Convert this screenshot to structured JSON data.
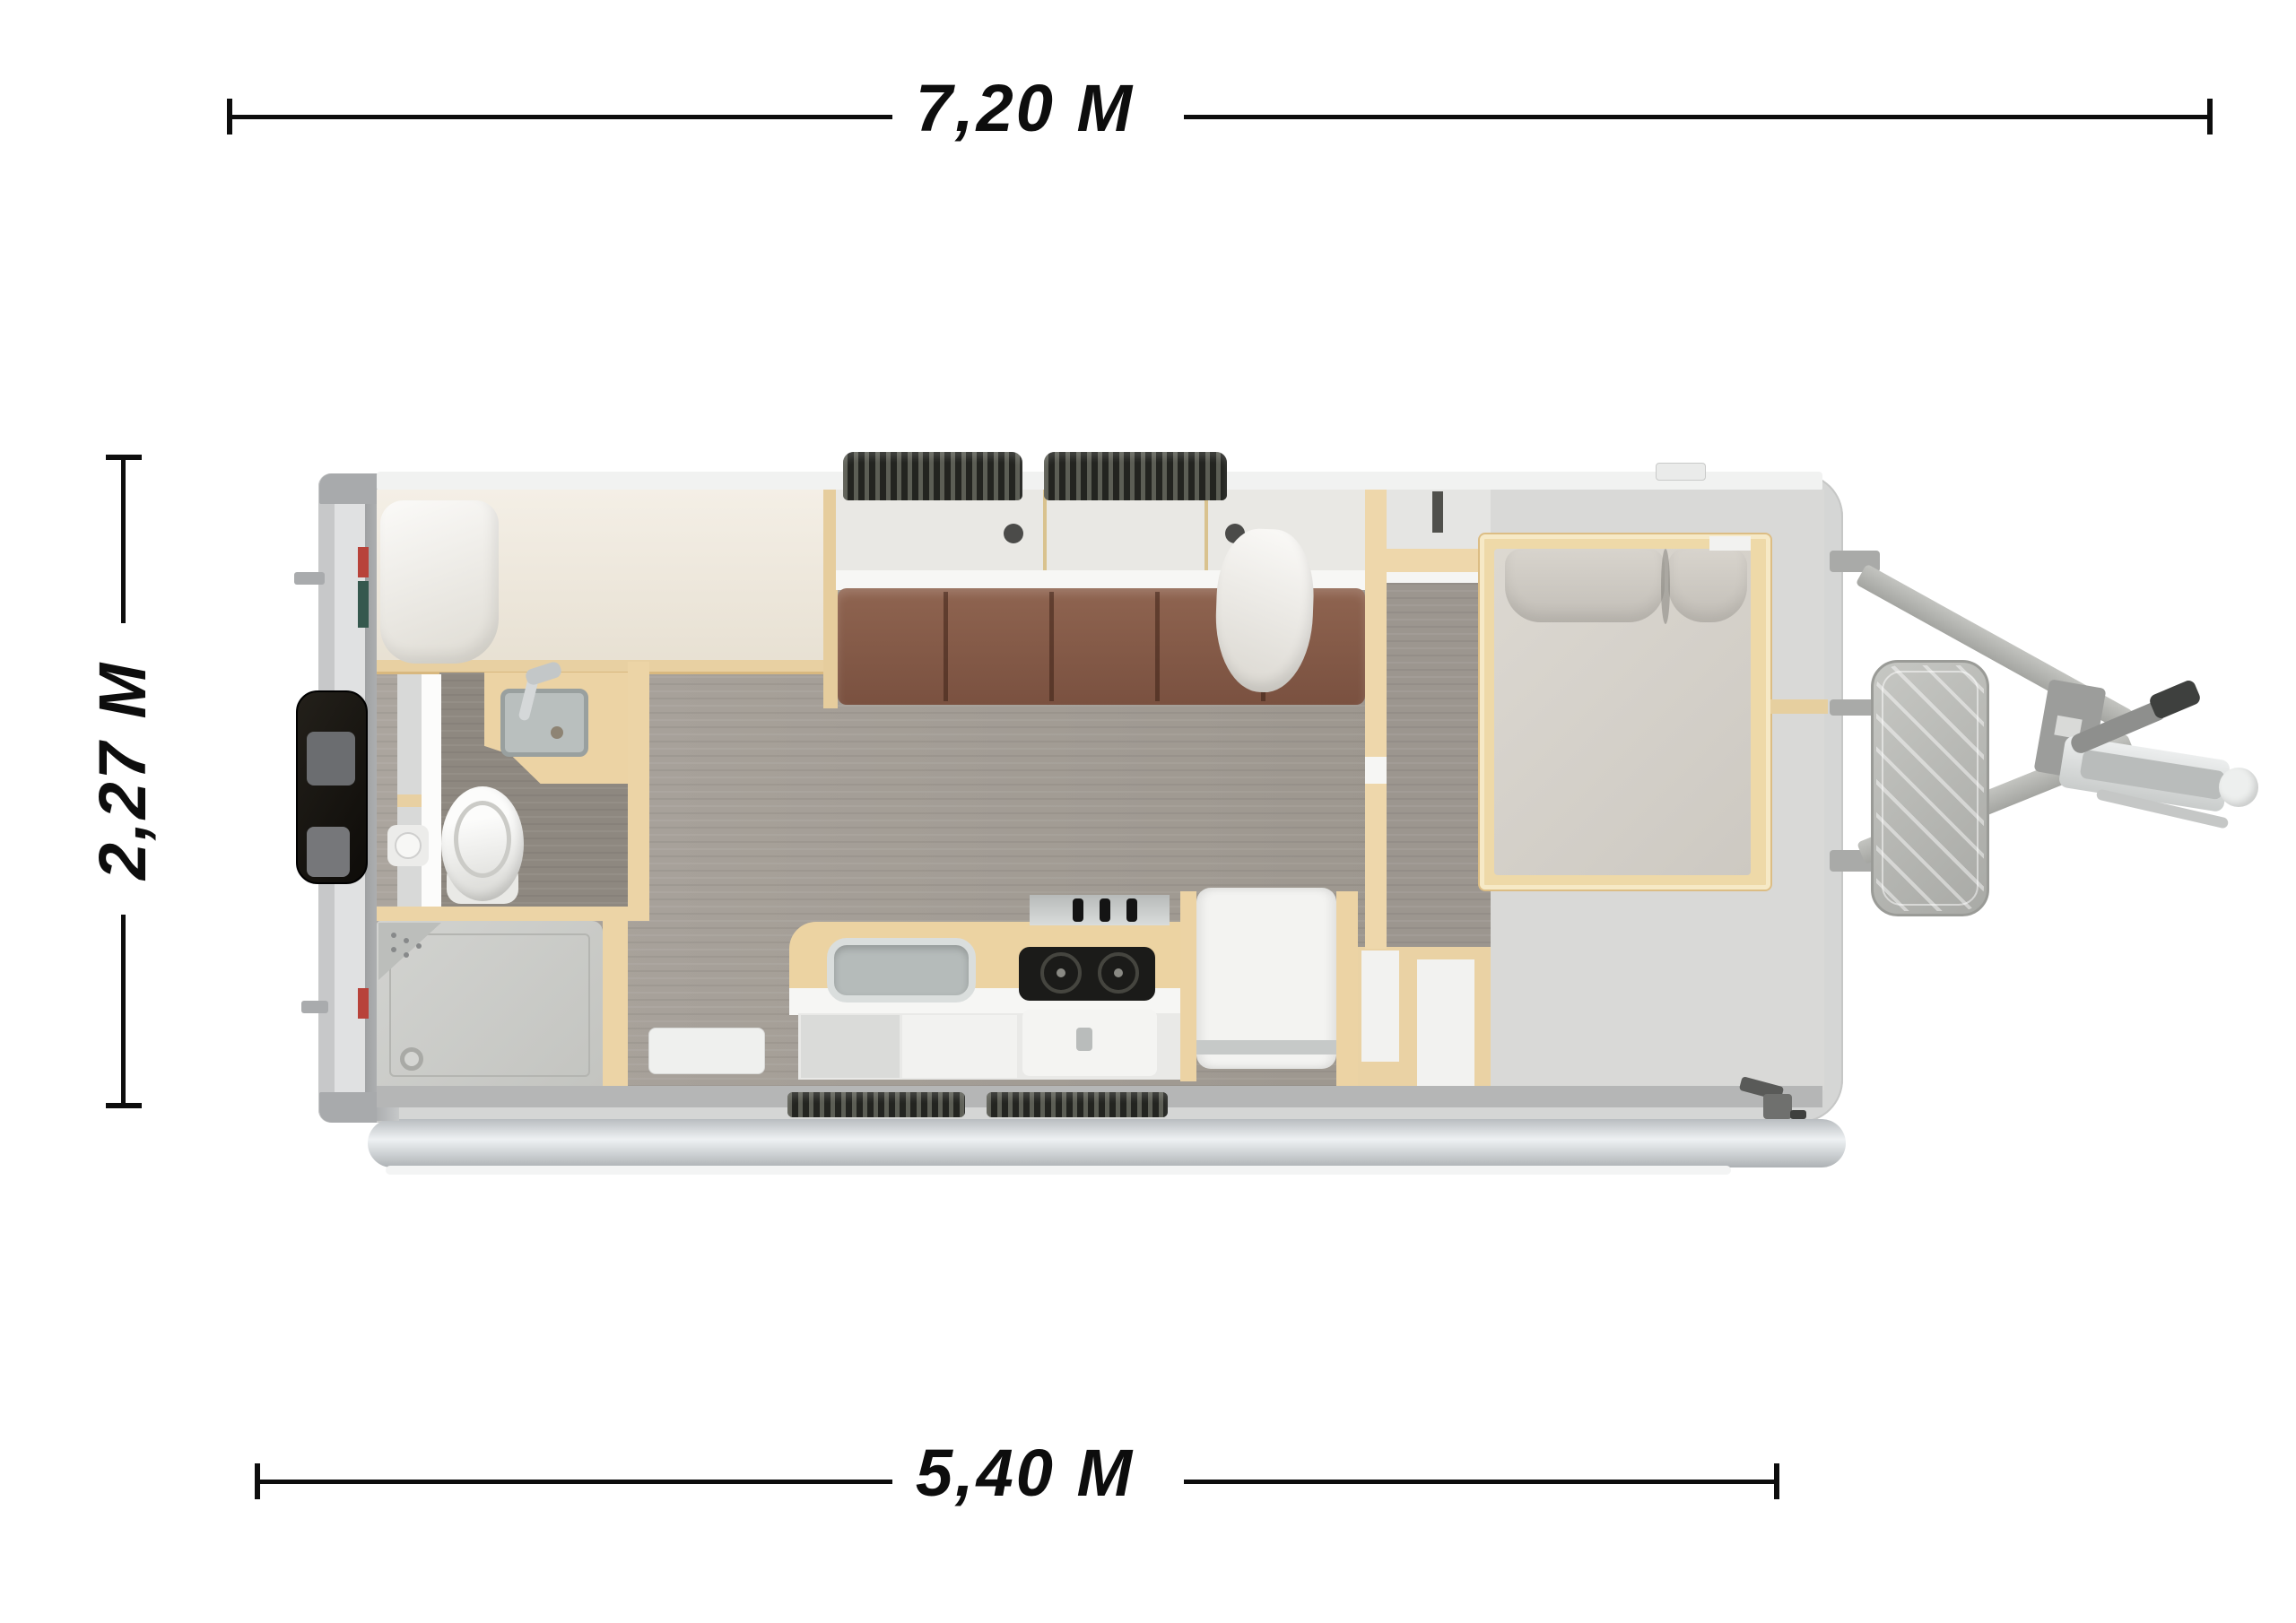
{
  "page": {
    "background_color": "#ffffff",
    "view": "caravan-top-view-floorplan"
  },
  "dimension_annotations": {
    "overall_length": {
      "label": "7,20 M",
      "position": "top"
    },
    "body_width": {
      "label": "2,27 M",
      "position": "left",
      "rotated": true
    },
    "body_length": {
      "label": "5,40 M",
      "position": "bottom"
    }
  },
  "style": {
    "annotation_color": "#0d0d0d",
    "shell_color": "#d5d6d5",
    "wood_trim_color": "#ecd3a4",
    "corridor_floor_color": "#a49e97",
    "bathroom_floor_color": "#8e8880",
    "front_floor_color": "#d9d9d7",
    "sofa_cushion_color": "#8a5c47",
    "mattress_color": "#d6d2cb",
    "tire_color": "#3a3b36",
    "hitch_metal_color": "#b3b4b0",
    "rear_box_color": "#17140f"
  },
  "floorplan": {
    "elements": [
      "rear-storage-box",
      "rear-marker-lights",
      "bunk-bed",
      "bunk-pillow",
      "bathroom-sink",
      "bathroom-faucet",
      "toilet",
      "toilet-cassette-knob",
      "shower-tray",
      "shower-drain",
      "shower-corner-shelf",
      "entry-step",
      "sofa-backrest",
      "sofa-cushions",
      "sofa-pillow",
      "sofa-table-knobs",
      "kitchen-counter",
      "kitchen-sink",
      "stove",
      "stove-knobs",
      "oven",
      "fridge",
      "bench-cabinet",
      "wardrobe-wall",
      "double-bed",
      "bed-pillows",
      "wheels-top",
      "wheels-bottom",
      "side-rail",
      "gas-locker-box",
      "drawbar-arms",
      "hitch-coupling",
      "handbrake-lever",
      "corner-steady"
    ]
  }
}
